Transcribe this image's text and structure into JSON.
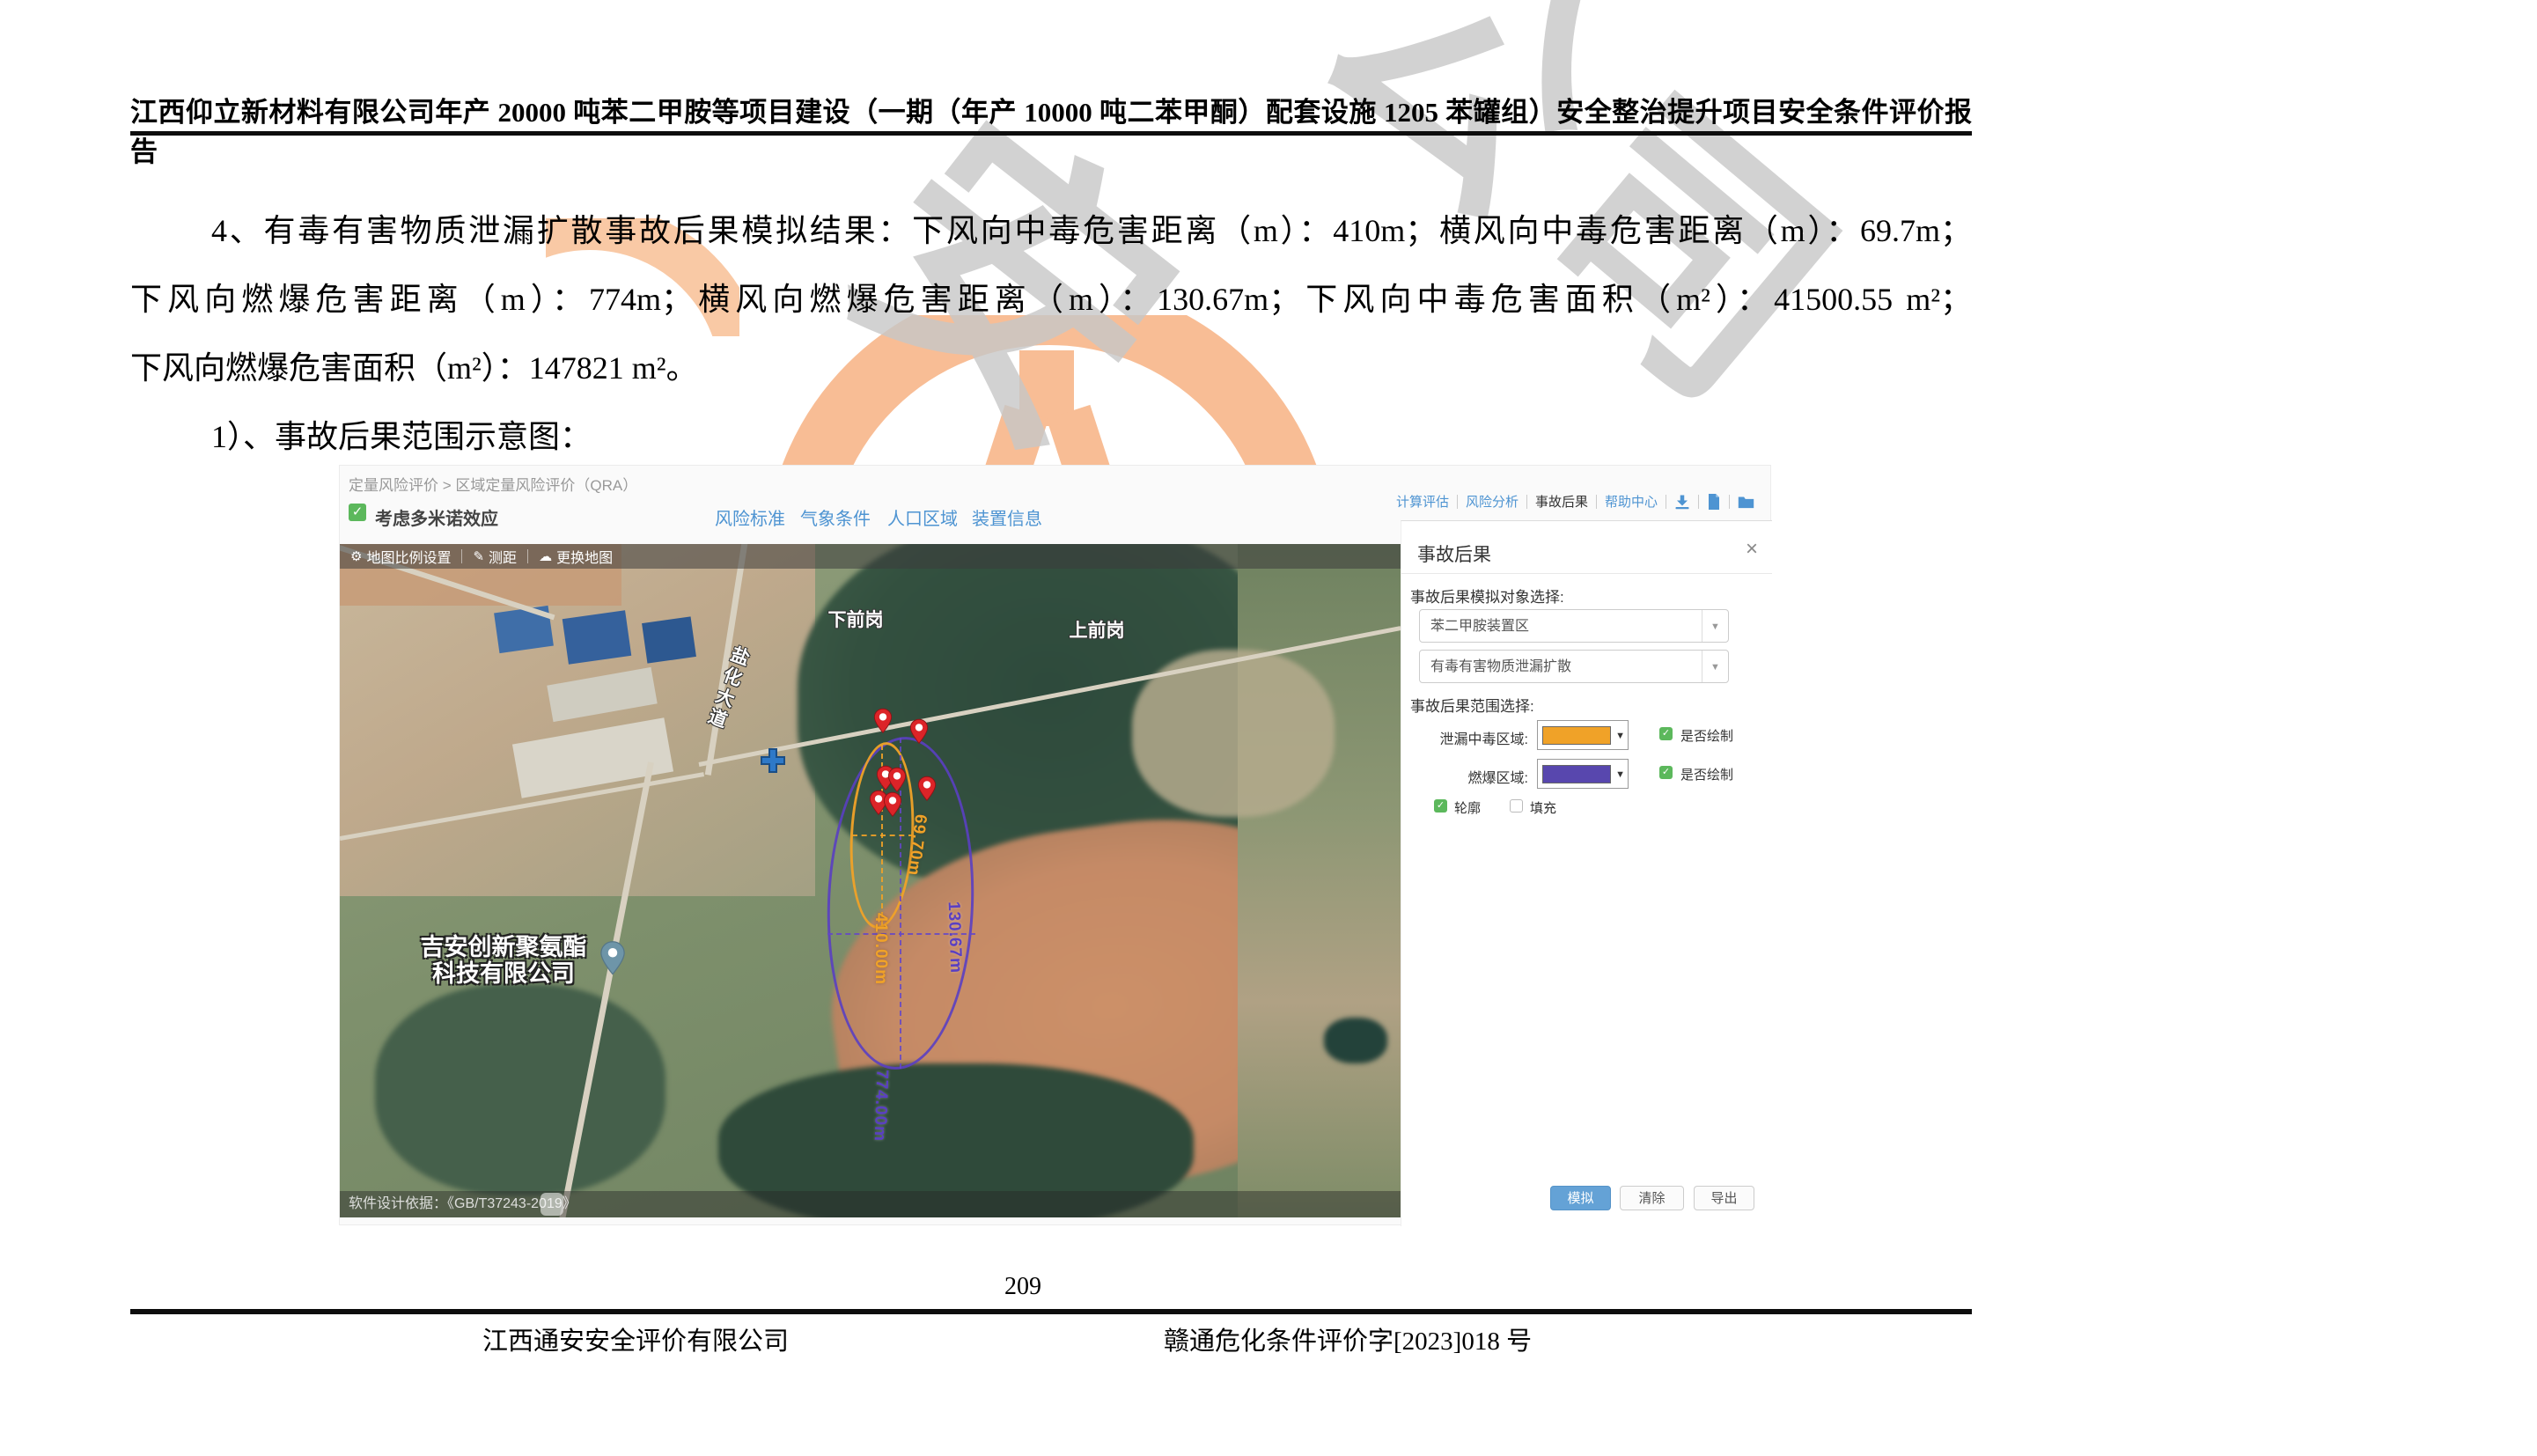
{
  "document": {
    "header_title": "江西仰立新材料有限公司年产 20000 吨苯二甲胺等项目建设（一期（年产 10000 吨二苯甲酮）配套设施 1205 苯罐组）安全整治提升项目安全条件评价报告",
    "body_lines": [
      "4、有毒有害物质泄漏扩散事故后果模拟结果：下风向中毒危害距离（m）：410m；横风向中毒危害距离（m）：69.7m；",
      "下风向燃爆危害距离（m）：774m；横风向燃爆危害距离（m）：130.67m；下风向中毒危害面积（m²）：41500.55 m²；",
      "下风向燃爆危害面积（m²）：147821 m²。",
      "1）、事故后果范围示意图："
    ],
    "page_number": "209",
    "footer_left": "江西通安安全评价有限公司",
    "footer_right": "赣通危化条件评价字[2023]018 号",
    "watermark": {
      "char_a": "安",
      "char_b": "公司"
    }
  },
  "app": {
    "breadcrumb": "定量风险评价 > 区域定量风险评价（QRA）",
    "domino_checkbox_label": "考虑多米诺效应",
    "top_links": [
      "风险标准",
      "气象条件",
      "人口区域",
      "装置信息"
    ],
    "nav_links": [
      "计算评估",
      "风险分析",
      "事故后果",
      "帮助中心"
    ],
    "map_toolbar": [
      "地图比例设置",
      "测距",
      "更换地图"
    ],
    "map": {
      "place_labels": {
        "village_top": "下前岗",
        "village_right": "上前岗",
        "road": "盐化大道",
        "company_line1": "吉安创新聚氨酯",
        "company_line2": "科技有限公司"
      },
      "measurements": {
        "toxic_width": "69.70m",
        "toxic_length": "410.00m",
        "blast_width": "130.67m",
        "blast_length": "774.00m"
      },
      "attribution": "软件设计依据：《GB/T37243-2019》"
    },
    "panel": {
      "title": "事故后果",
      "sim_object_label": "事故后果模拟对象选择:",
      "select_device": "苯二甲胺装置区",
      "select_scenario": "有毒有害物质泄漏扩散",
      "range_label": "事故后果范围选择:",
      "toxic_row_label": "泄漏中毒区域:",
      "blast_row_label": "燃爆区域:",
      "draw_label1": "是否绘制",
      "draw_label2": "是否绘制",
      "outline_label": "轮廓",
      "fill_label": "填充",
      "buttons": {
        "simulate": "模拟",
        "clear": "清除",
        "export": "导出"
      }
    },
    "colors": {
      "toxic_zone": "#F0A228",
      "blast_zone": "#5A3FC2",
      "link_blue": "#4E94D2",
      "check_green": "#5CB85C",
      "primary_button": "#64A2D6",
      "pin_red": "#DC2428"
    }
  }
}
